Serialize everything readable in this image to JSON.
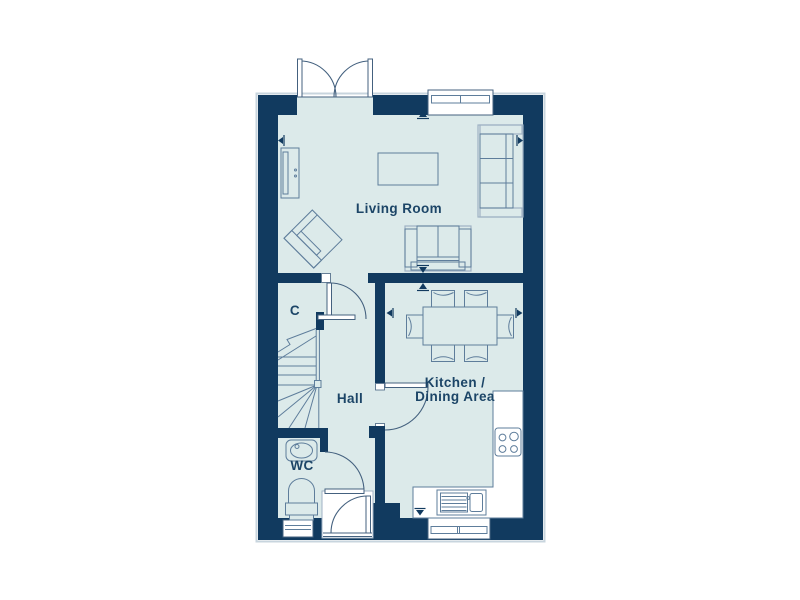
{
  "plan": {
    "title": "ground-floor-plan",
    "rooms": {
      "living_room": {
        "label": "Living Room"
      },
      "kitchen_dining": {
        "label_line1": "Kitchen /",
        "label_line2": "Dining Area"
      },
      "hall": {
        "label": "Hall"
      },
      "cupboard": {
        "label": "C"
      },
      "wc": {
        "label": "WC"
      }
    },
    "colors": {
      "wall": "#113A5F",
      "floor": "#DCEAEA",
      "outer_outline": "#C8D5DE",
      "furniture_stroke": "#5E7D9B",
      "furniture_stroke_light": "#9FB2C4",
      "detail_stroke": "#44617F",
      "label_text": "#1C4567",
      "background": "#FFFFFF"
    },
    "fixtures": [
      "french-double-doors",
      "front-door",
      "wc-door",
      "kitchen-door",
      "hall-door",
      "cupboard-door",
      "winder-stairs",
      "sofa-3-seat",
      "loveseat-2-seat",
      "armchair",
      "coffee-table",
      "tv-unit",
      "dining-table",
      "dining-chairs-x6",
      "kitchen-counter-L",
      "hob-4-ring",
      "sink-with-drainer",
      "wash-basin",
      "toilet",
      "window-top",
      "window-kitchen",
      "window-wc"
    ]
  }
}
